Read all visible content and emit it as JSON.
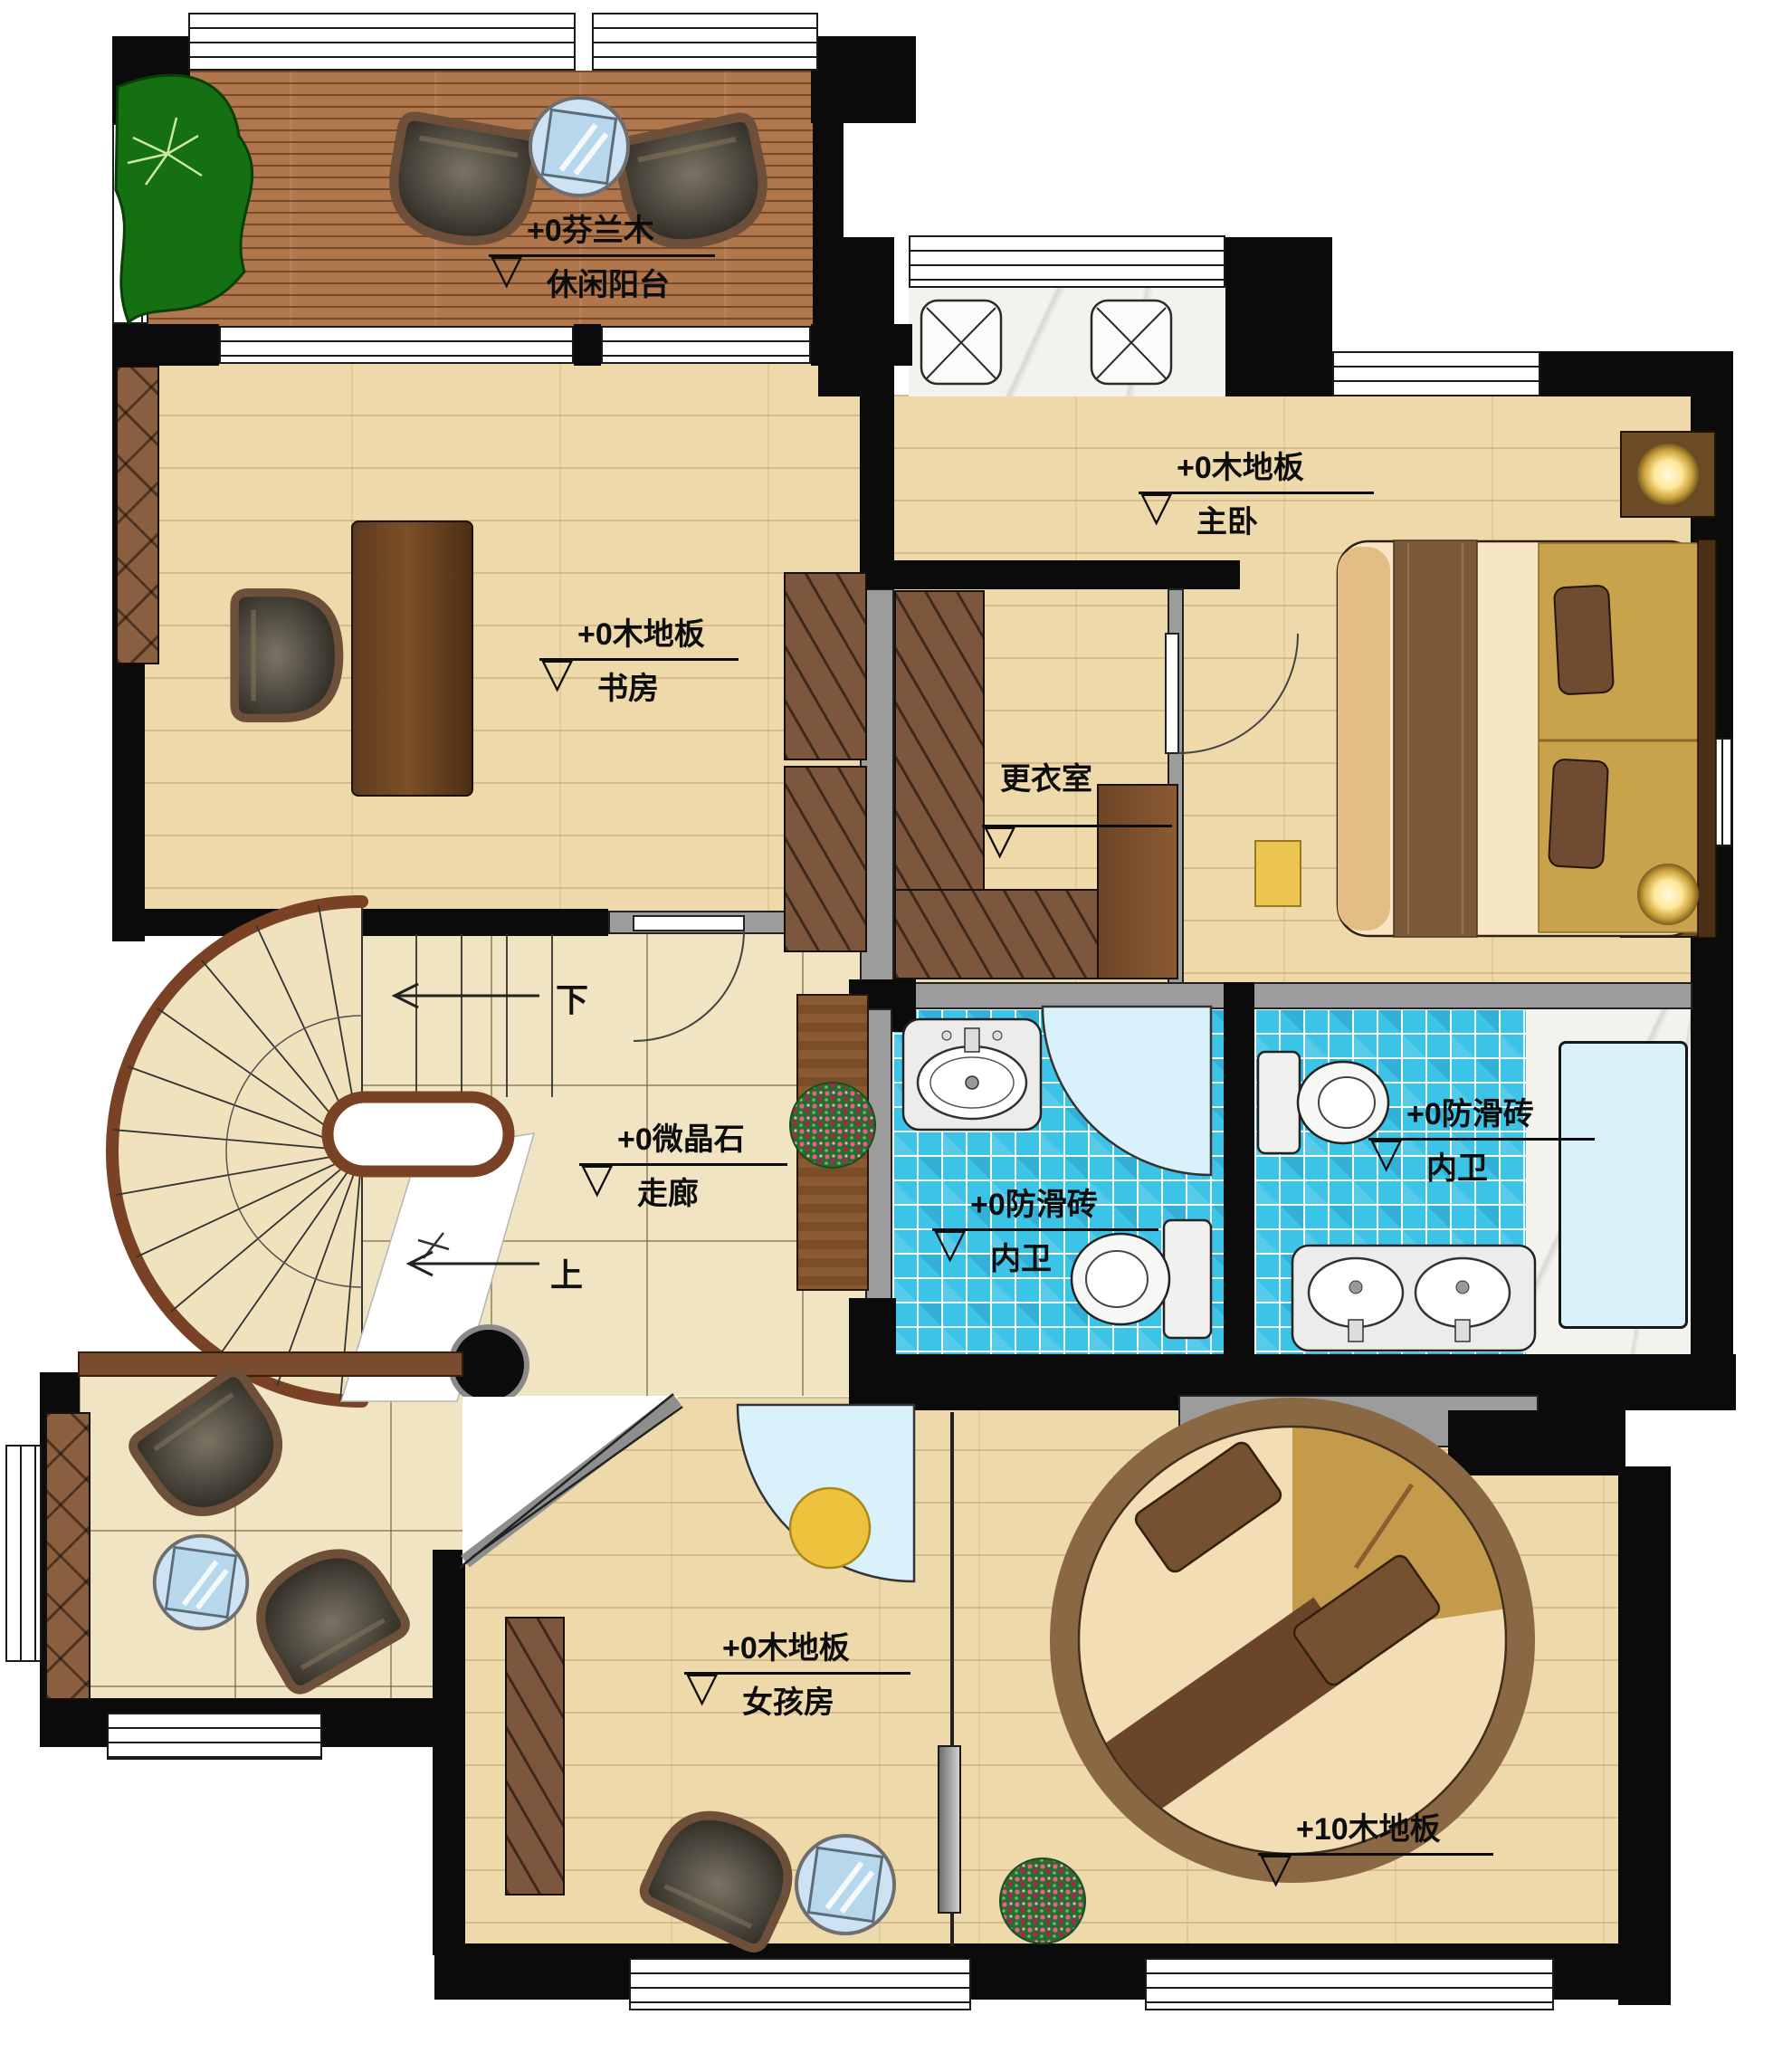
{
  "labels": {
    "marker": "▽"
  },
  "rooms": {
    "balcony": {
      "material": "+0芬兰木",
      "name": "休闲阳台"
    },
    "study": {
      "material": "+0木地板",
      "name": "书房"
    },
    "master_bedroom": {
      "material": "+0木地板",
      "name": "主卧"
    },
    "dressing_room": {
      "name": "更衣室"
    },
    "corridor": {
      "material": "+0微晶石",
      "name": "走廊"
    },
    "bathroom_left": {
      "material": "+0防滑砖",
      "name": "内卫"
    },
    "bathroom_right": {
      "material": "+0防滑砖",
      "name": "内卫"
    },
    "girls_room": {
      "material": "+0木地板",
      "name": "女孩房"
    },
    "platform_bedroom": {
      "material": "+10木地板"
    }
  },
  "stairs": {
    "down": "下",
    "up": "上"
  },
  "colors": {
    "wall": "#0b0b0b",
    "wood": "#eed9ab",
    "deck": "#b0764c",
    "tile": "#f0e4c2",
    "mosaic": "#3cc3e8",
    "shower": "#d8f1fb",
    "plant": "#157012",
    "accent_yellow": "#ecc550",
    "wardrobe": "#7d573d"
  }
}
